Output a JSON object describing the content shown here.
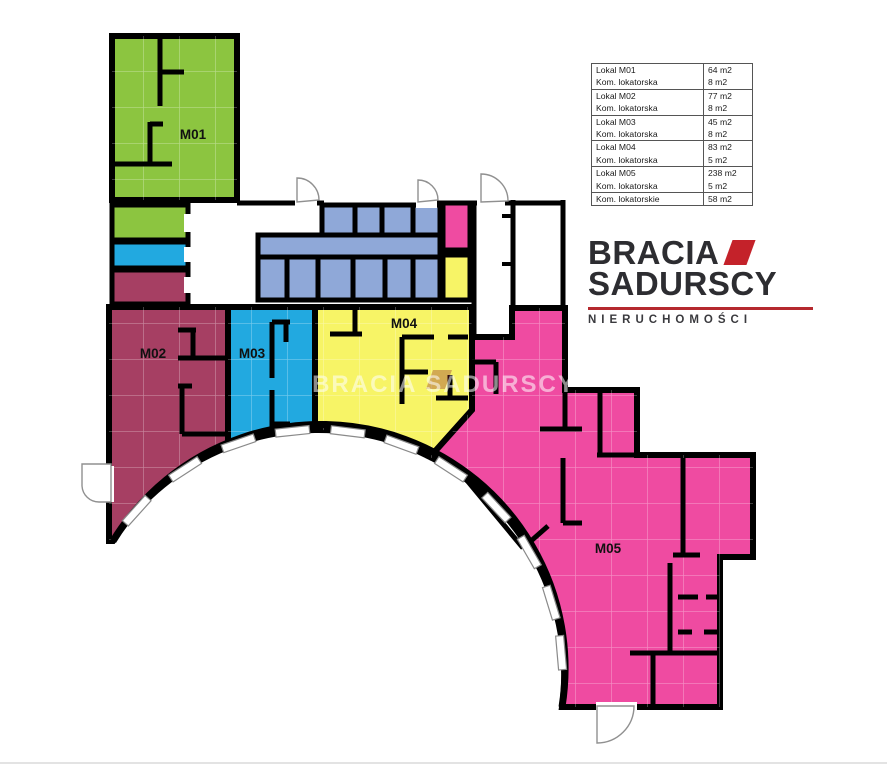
{
  "page": {
    "background": "#ffffff",
    "width": 887,
    "height": 768
  },
  "area_table": {
    "groups": [
      {
        "rows": [
          {
            "label": "Lokal M01",
            "value": "64 m2"
          },
          {
            "label": "Kom. lokatorska",
            "value": "8 m2"
          }
        ]
      },
      {
        "rows": [
          {
            "label": "Lokal M02",
            "value": "77 m2"
          },
          {
            "label": "Kom. lokatorska",
            "value": "8 m2"
          }
        ]
      },
      {
        "rows": [
          {
            "label": "Lokal M03",
            "value": "45 m2"
          },
          {
            "label": "Kom. lokatorska",
            "value": "8 m2"
          }
        ]
      },
      {
        "rows": [
          {
            "label": "Lokal M04",
            "value": "83 m2"
          },
          {
            "label": "Kom. lokatorska",
            "value": "5 m2"
          }
        ]
      },
      {
        "rows": [
          {
            "label": "Lokal M05",
            "value": "238 m2"
          },
          {
            "label": "Kom. lokatorska",
            "value": "5 m2"
          }
        ]
      },
      {
        "rows": [
          {
            "label": "Kom. lokatorskie",
            "value": "58 m2"
          }
        ]
      }
    ]
  },
  "logo": {
    "brand_line1": "BRACIA",
    "brand_line2": "SADURSCY",
    "tagline": "NIERUCHOMOŚCI",
    "accent_color": "#C4222A",
    "text_color": "#2D2D31"
  },
  "floor_plan": {
    "watermark": "BRACIA SADURSCY",
    "wall_color": "#000000",
    "storage_color": "#8FA8D8",
    "units": [
      {
        "label": "M01",
        "color": "#8CC540"
      },
      {
        "label": "M02",
        "color": "#A63F63"
      },
      {
        "label": "M03",
        "color": "#22A9E0"
      },
      {
        "label": "M04",
        "color": "#F7F466"
      },
      {
        "label": "M05",
        "color": "#EF4BA1"
      }
    ]
  }
}
